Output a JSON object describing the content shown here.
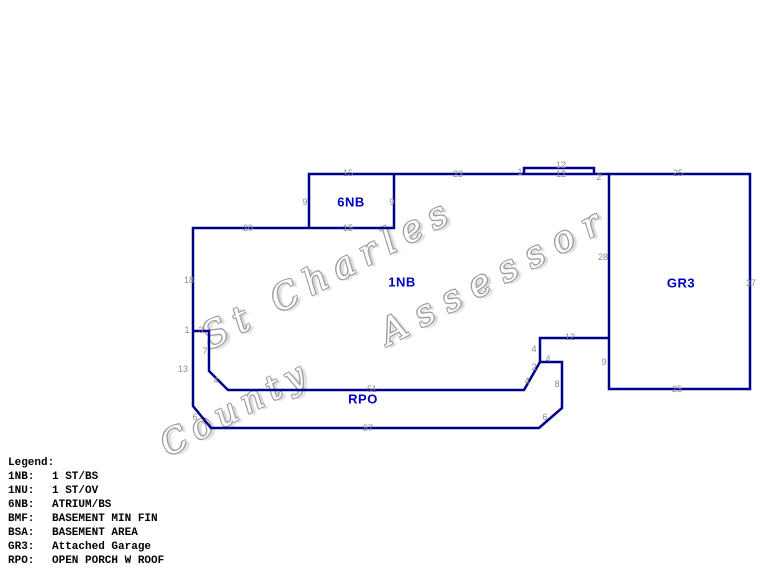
{
  "watermark": {
    "part1": "St Charles",
    "part2": "County",
    "part3": "Assessor"
  },
  "sketch": {
    "area_labels": [
      "6NB",
      "1NB",
      "GR3",
      "RPO"
    ],
    "dims": [
      "15",
      "23",
      "1",
      "12",
      "12",
      "2",
      "25",
      "9",
      "9",
      "20",
      "15",
      "18",
      "28",
      "37",
      "1",
      "3",
      "7",
      "12",
      "4",
      "4",
      "2",
      "9",
      "13",
      "4",
      "4",
      "8",
      "51",
      "25",
      "6",
      "6",
      "57"
    ]
  },
  "legend": {
    "title": "Legend:",
    "entries": [
      {
        "code": "1NB:",
        "desc": "1 ST/BS"
      },
      {
        "code": "1NU:",
        "desc": "1 ST/OV"
      },
      {
        "code": "6NB:",
        "desc": "ATRIUM/BS"
      },
      {
        "code": "BMF:",
        "desc": "BASEMENT MIN FIN"
      },
      {
        "code": "BSA:",
        "desc": "BASEMENT AREA"
      },
      {
        "code": "GR3:",
        "desc": "Attached Garage"
      },
      {
        "code": "RPO:",
        "desc": "OPEN PORCH W ROOF"
      }
    ]
  },
  "colors": {
    "outline": "#00008b",
    "area_label": "#0000c0",
    "dimension_text": "#8c8c8c",
    "watermark_outline": "#9c9c9c",
    "legend_text": "#000000",
    "background": "#ffffff"
  }
}
